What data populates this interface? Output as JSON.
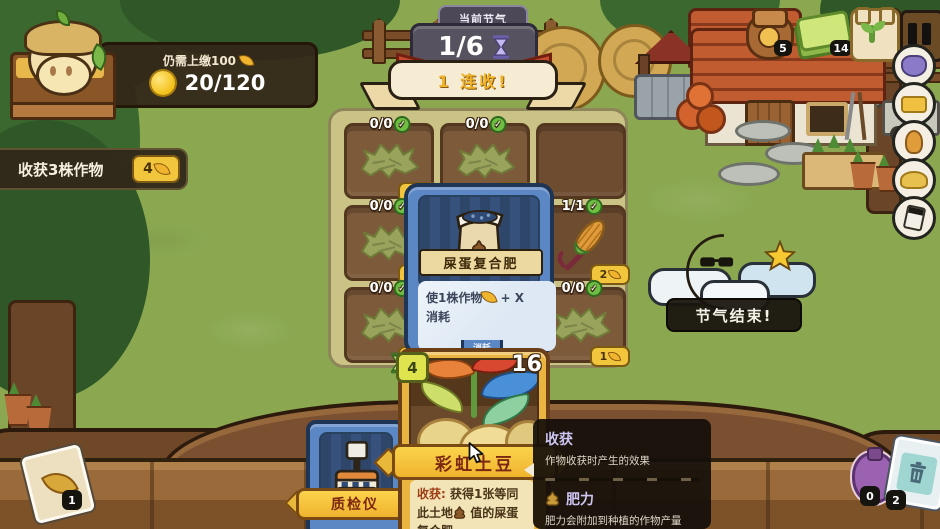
{
  "hud": {
    "tax": {
      "label": "仍需上缴100",
      "coins": "20/120"
    },
    "quest": {
      "text": "收获3株作物",
      "reward": "4"
    },
    "season": {
      "tab": "当前节气",
      "progress": "1/6",
      "combo": "1 连收!"
    },
    "top_right": {
      "bag_count": "5",
      "card_count": "14"
    },
    "moon_banner": "节气结束!"
  },
  "grid": {
    "plots": [
      {
        "label": "0/0",
        "badge": "1"
      },
      {
        "label": "0/0",
        "badge": "1"
      },
      {
        "label": "",
        "badge": ""
      },
      {
        "label": "0/0",
        "badge": "1"
      },
      {
        "label": "",
        "badge": ""
      },
      {
        "label": "1/1",
        "badge": "2"
      },
      {
        "label": "0/0",
        "badge": "1"
      },
      {
        "label": "",
        "badge": ""
      },
      {
        "label": "0/0",
        "badge": "1"
      }
    ]
  },
  "fertilizer_card": {
    "name": "屎蛋复合肥",
    "effect_prefix": "使1株作物",
    "effect_suffix": "+ X",
    "effect_line2": "消耗",
    "tab": "消耗"
  },
  "potato_card": {
    "cost": "4",
    "value": "16",
    "name": "彩虹土豆",
    "desc_label": "收获:",
    "desc_a": "获得1张等同此土地",
    "desc_b": "值的屎蛋复合肥"
  },
  "machine": {
    "name": "质检仪"
  },
  "tooltip": {
    "harvest_title": "收获",
    "harvest_desc": "作物收获时产生的效果",
    "fertility_title": "肥力",
    "fertility_desc": "肥力会附加到种植的作物产量上，季节结束时重置"
  },
  "inventory": {
    "leaf_card_count": "1",
    "pouch_count": "0",
    "trash_count": "2"
  },
  "icons": {
    "check": "✓"
  },
  "colors": {
    "accent_gold": "#f2c63c",
    "card_blue": "#5b87c4",
    "grass": "#8ba851"
  }
}
